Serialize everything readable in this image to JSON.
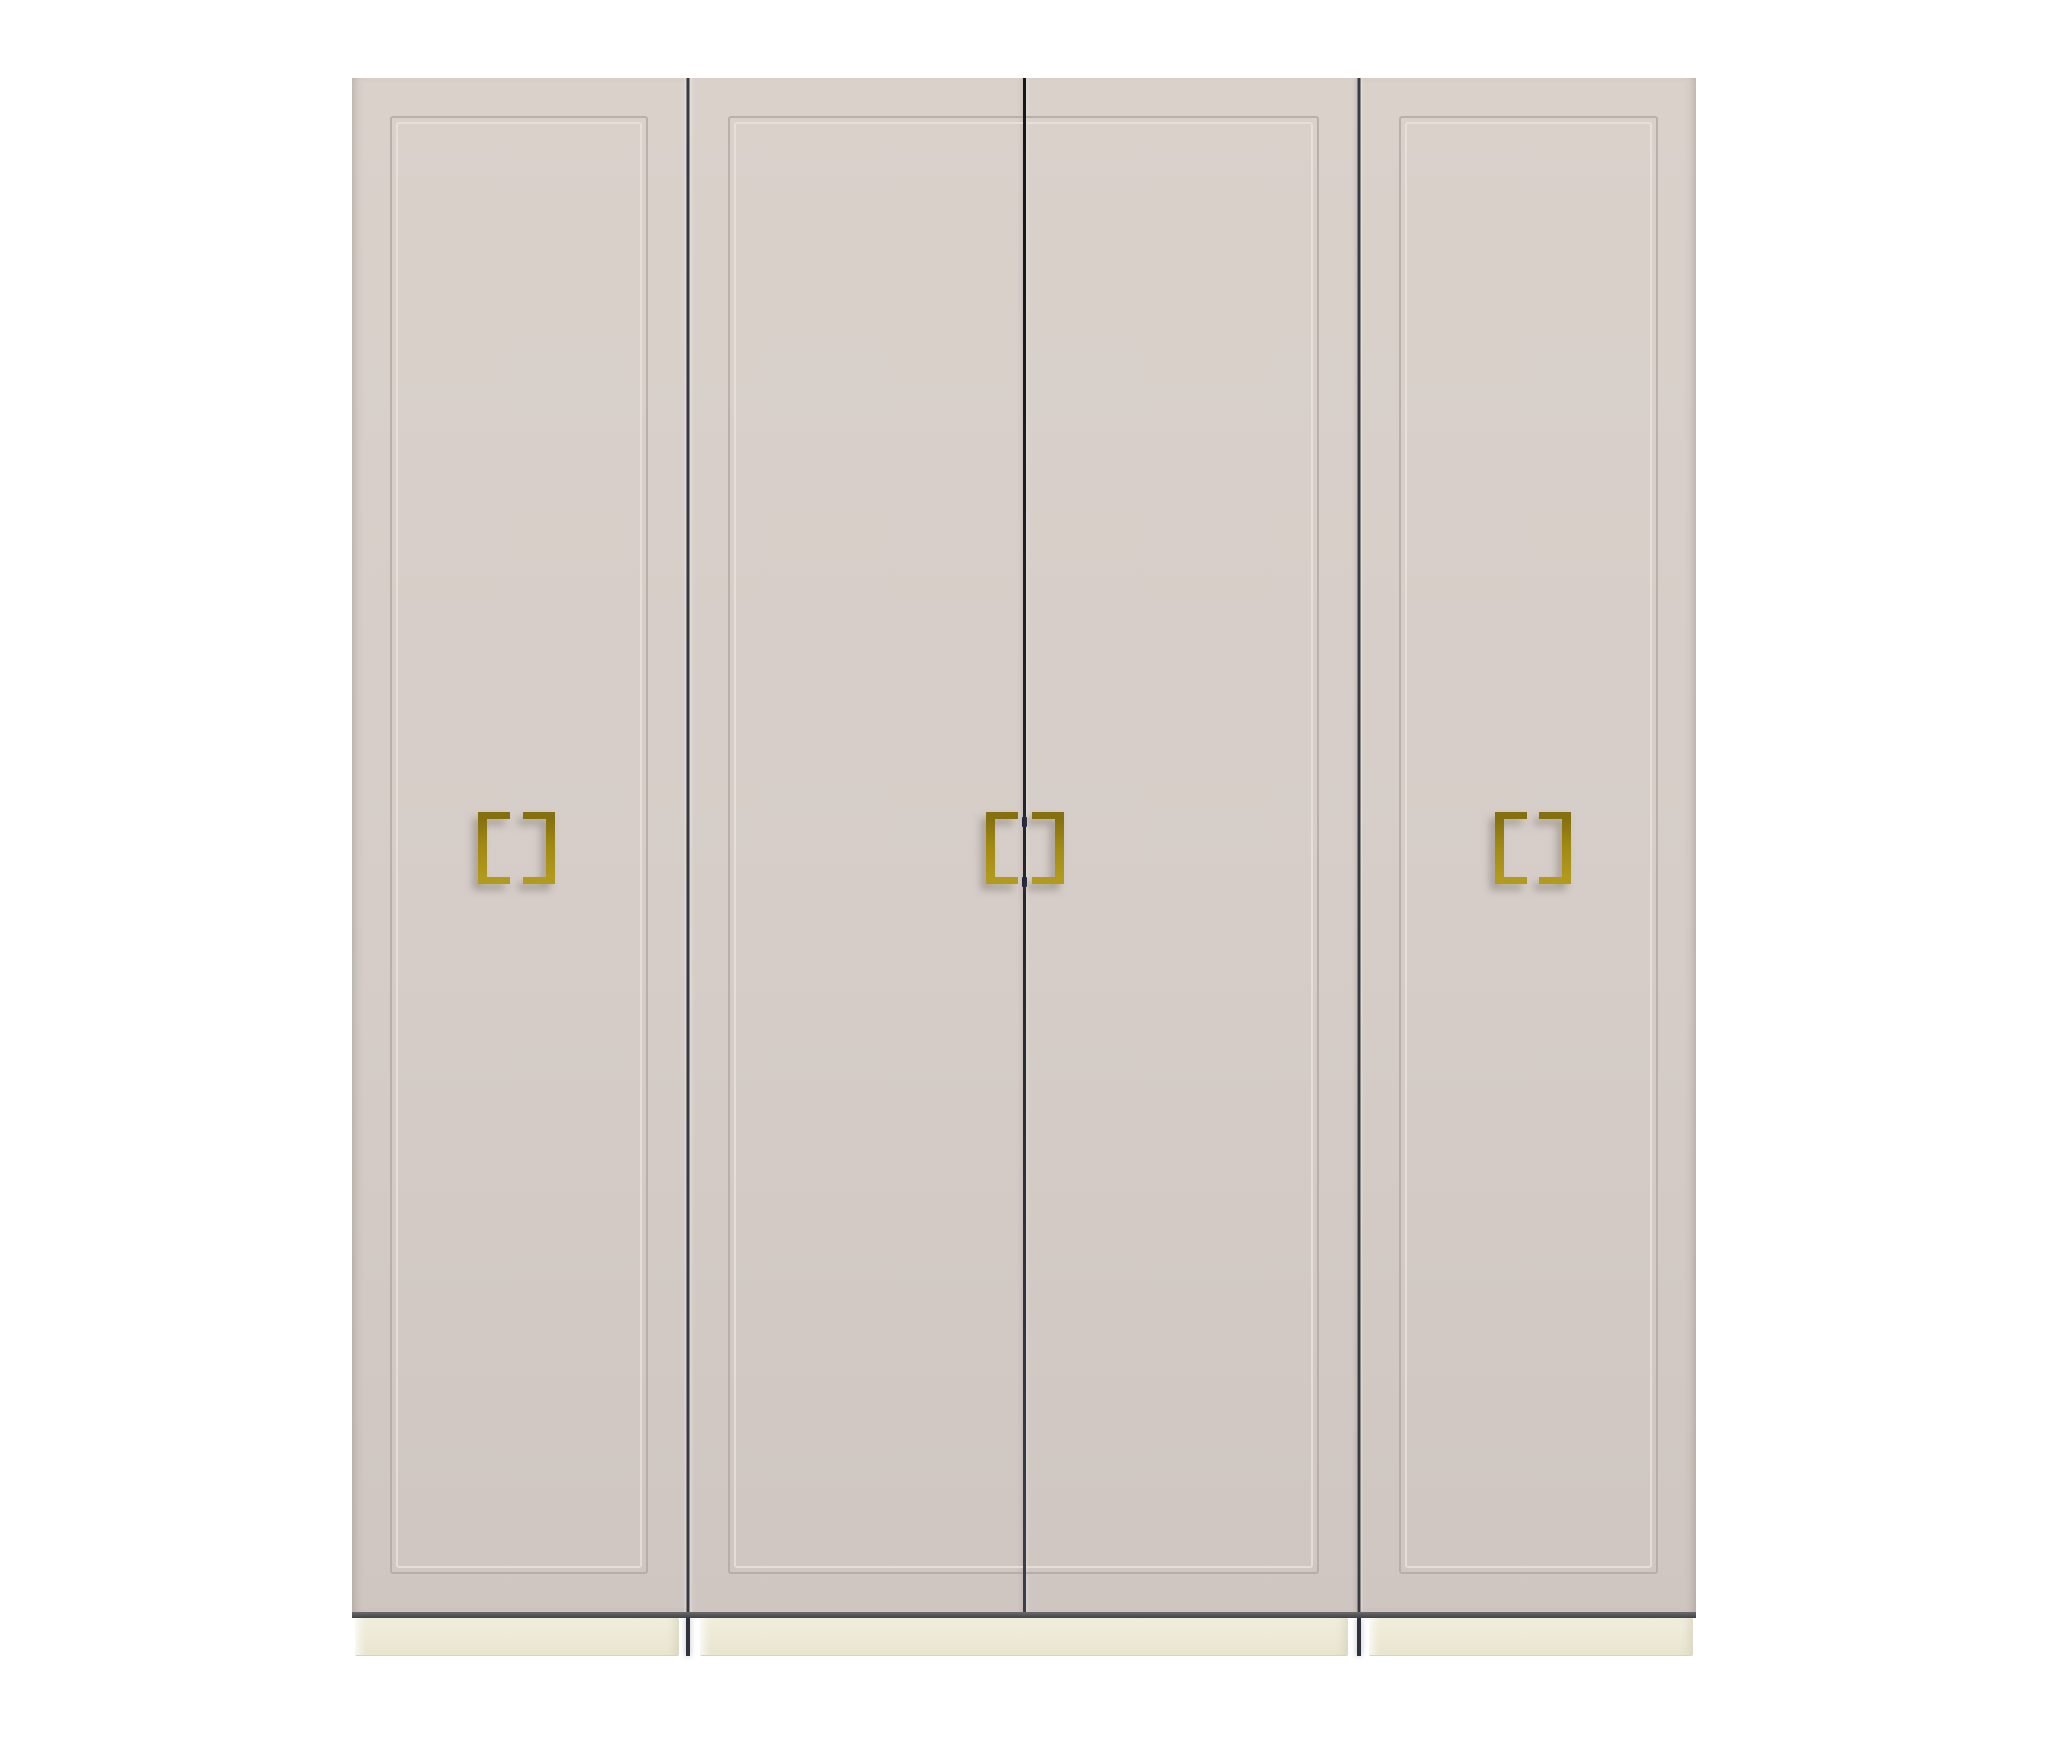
{
  "scene": {
    "type": "product-render",
    "object": "four-door wardrobe",
    "background": "plain white",
    "doors": [
      {
        "id": 1,
        "panel": "recessed rectangular trim",
        "handle": "double square-bracket pull, centered"
      },
      {
        "id": 2,
        "panel": "shared recessed trim with door 3",
        "handle": "single left bracket beside center gap"
      },
      {
        "id": 3,
        "panel": "shared recessed trim with door 2",
        "handle": "single right bracket beside center gap"
      },
      {
        "id": 4,
        "panel": "recessed rectangular trim",
        "handle": "double square-bracket pull, centered"
      }
    ],
    "base": "cream plinth in three sections",
    "handle_material": "brass / gold",
    "handle_count": 6
  },
  "colors": {
    "background": "#ffffff",
    "door-face": "#d6cdc8",
    "door-face-light": "#dad1cb",
    "door-face-dark": "#cfc6c1",
    "groove-dark": "#b3a8a2",
    "groove-light": "#ece3dc",
    "seam-dark": "#2f333e",
    "seam-flank-l": "#b7afa9",
    "seam-flank-r": "#c0b8b2",
    "center-gap-top": "#14161c",
    "center-gap-bottom": "#39404c",
    "gap-pin": "#23263b",
    "bottom-edge-top": "#6b6a6b",
    "bottom-edge-bottom": "#414348",
    "plinth": "#f1eedd",
    "plinth-dark": "#e9e5cf",
    "plinth-edge": "#d8d4bc",
    "handle-gold": "#a18813",
    "handle-gold-dark": "#84700e",
    "handle-gold-bright": "#b29a1d",
    "handle-shadow": "rgba(120,112,104,0.5)",
    "edge-shade": "rgba(120,110,105,0.45)"
  }
}
